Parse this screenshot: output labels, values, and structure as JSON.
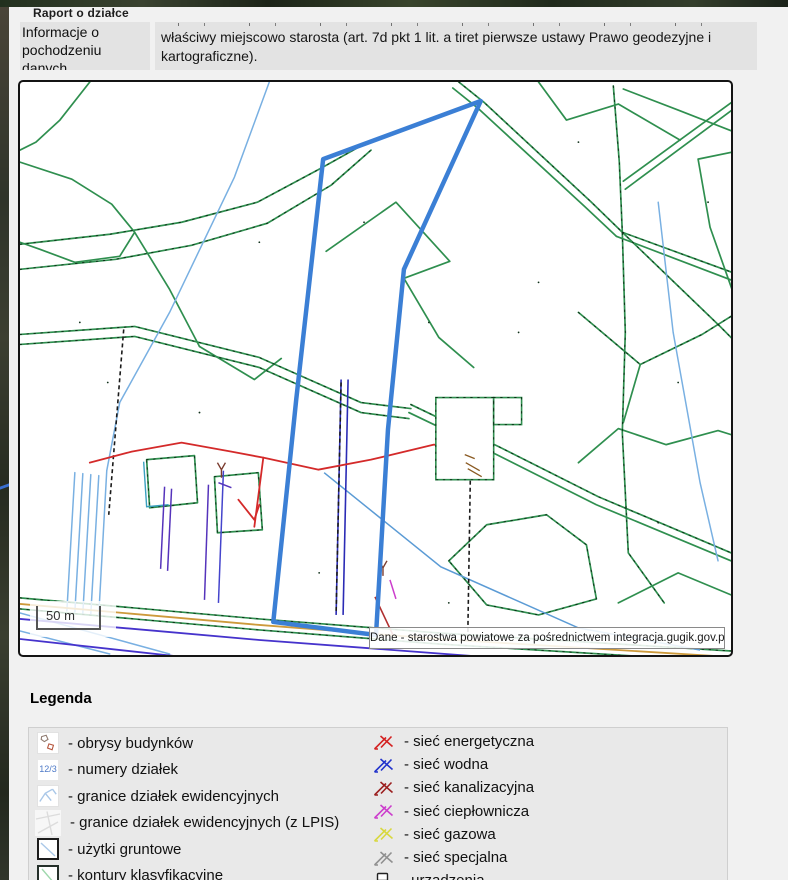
{
  "window": {
    "title": "Raport o działce"
  },
  "info_section": {
    "label": "Informacje o pochodzeniu danych",
    "text": "właściwy miejscowo starosta (art. 7d pkt 1 lit. a tiret pierwsze ustawy Prawo geodezyjne i kartograficzne)."
  },
  "map": {
    "scale_label": "50 m",
    "attribution": "Dane - starostwa powiatowe za pośrednictwem integracja.gugik.gov.pl",
    "colors": {
      "selected_parcel": "#3b7fd5",
      "parcel_boundary": "#2f8f4f",
      "water_line": "#79b0e2",
      "power_line": "#d42a2a",
      "road_utility": "#cd9a3c",
      "underground": "#2b2bb5"
    }
  },
  "legend": {
    "heading": "Legenda",
    "left_items": [
      {
        "label": "- obrysy budynków",
        "icon": "building-outlines-icon"
      },
      {
        "label": "- numery działek",
        "icon": "parcel-numbers-icon",
        "icon_text": "12/3"
      },
      {
        "label": "- granice działek ewidencyjnych",
        "icon": "parcel-boundaries-icon"
      },
      {
        "label": "- granice działek ewidencyjnych (z LPIS)",
        "icon": "parcel-boundaries-lpis-icon"
      },
      {
        "label": "- użytki gruntowe",
        "icon": "land-use-icon"
      },
      {
        "label": "- kontury klasyfikacyjne",
        "icon": "classification-contours-icon"
      }
    ],
    "right_items": [
      {
        "label": "- sieć energetyczna",
        "color": "#d42222"
      },
      {
        "label": "- sieć wodna",
        "color": "#2233cc"
      },
      {
        "label": "- sieć kanalizacyjna",
        "color": "#9c2020"
      },
      {
        "label": "- sieć ciepłownicza",
        "color": "#cc3ecc"
      },
      {
        "label": "- sieć gazowa",
        "color": "#d8d840"
      },
      {
        "label": "- sieć specjalna",
        "color": "#909090"
      },
      {
        "label": "- urzadzenia",
        "color": "#222222"
      }
    ]
  }
}
